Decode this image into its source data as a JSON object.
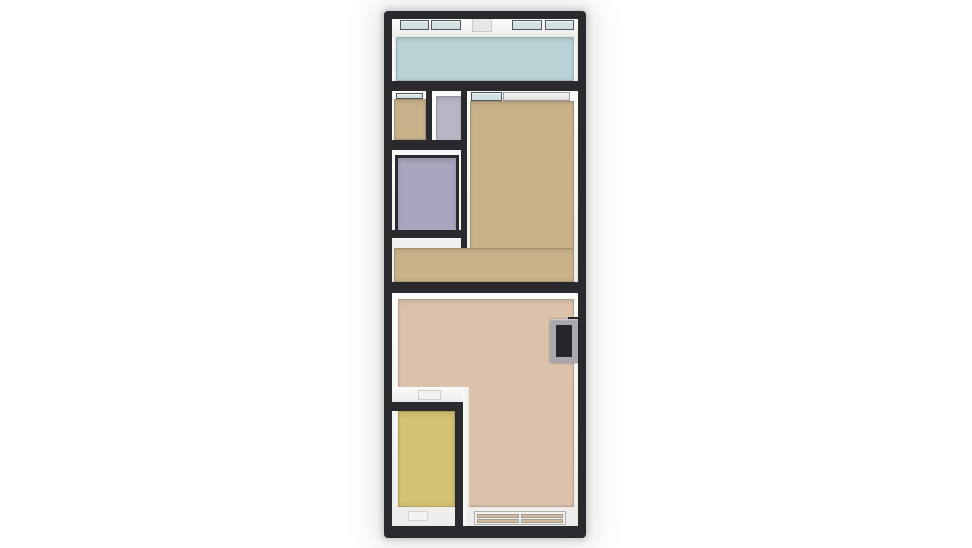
{
  "app": {
    "type": "3d-floorplan-top-down-render",
    "background": "#ffffff"
  },
  "palette": {
    "wall": "#2a2a2e",
    "wall_face": "#f3f3f2",
    "wall_trim": "#e7e7e5",
    "glass": "#cfe0e2",
    "window_pane": "#d0bb9e",
    "door_frame": "#a8a8ad",
    "door_void": "#26262a"
  },
  "rooms": [
    {
      "name": "balcony",
      "floor_color": "#b8d2d6"
    },
    {
      "name": "small-room-top-left",
      "floor_color": "#c8b28b"
    },
    {
      "name": "entry-nook",
      "floor_color": "#b7b6c4"
    },
    {
      "name": "bathroom",
      "floor_color": "#a8a5be"
    },
    {
      "name": "main-room-upper",
      "floor_color": "#c9b28a"
    },
    {
      "name": "main-room-lower",
      "floor_color": "#dcc2aa"
    },
    {
      "name": "kitchen",
      "floor_color": "#d4c171"
    }
  ]
}
